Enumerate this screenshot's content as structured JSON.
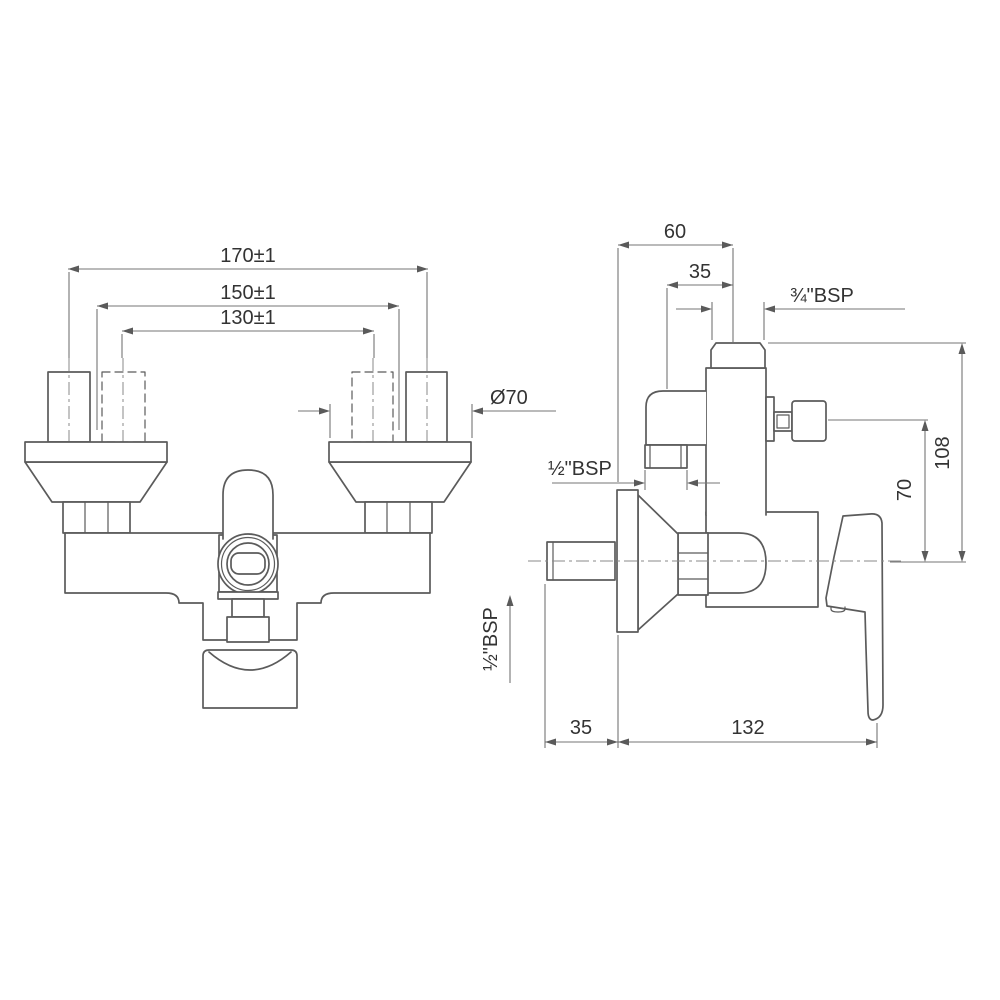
{
  "drawing": {
    "kind": "technical-dimension-drawing",
    "subject": "wall-mounted shower mixer, front and side elevations",
    "colors": {
      "background": "#ffffff",
      "object_line": "#5b5b5b",
      "dimension_line": "#757575",
      "text": "#333333"
    },
    "front": {
      "dim_outer": "170±1",
      "dim_mid": "150±1",
      "dim_inner": "130±1",
      "dia_flange": "Ø70"
    },
    "side": {
      "dim_60": "60",
      "dim_35_top": "35",
      "bsp_top": "¾\"BSP",
      "bsp_left": "½\"BSP",
      "dim_108": "108",
      "dim_70": "70",
      "bsp_bottom": "½\"BSP",
      "dim_35_bottom": "35",
      "dim_132": "132"
    }
  }
}
